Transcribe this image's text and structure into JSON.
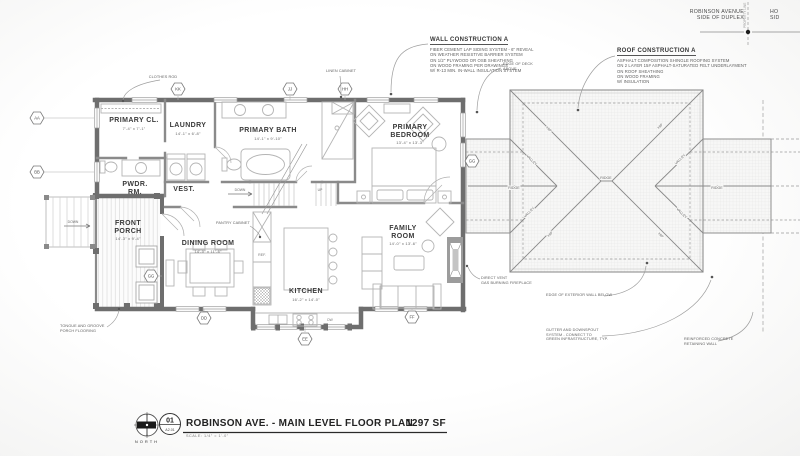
{
  "colors": {
    "wall": "#6e6e6e",
    "partition": "#8a8a8a",
    "furniture": "#b4b4b4",
    "roofline": "#8f8f8f",
    "text": "#3a3a3a"
  },
  "site": {
    "street_left_l1": "ROBINSON AVENUE",
    "street_left_l2": "SIDE OF DUPLEX",
    "street_right_l1": "HO",
    "street_right_l2": "SID",
    "property_line": "PROPERTY LINE"
  },
  "notes": {
    "wall_construction": {
      "title": "WALL CONSTRUCTION A",
      "lines": [
        "FIBER CEMENT LAP SIDING SYSTEM - 6\" REVEAL",
        "ON WEATHER RESISTIVE BARRIER SYSTEM",
        "ON 1/2\" PLYWOOD OR OSB SHEATHING",
        "ON WOOD FRAMING PER DRAWINGS",
        "W/ R-13 MIN. IN-WALL INSULATION SYSTEM"
      ]
    },
    "roof_construction": {
      "title": "ROOF CONSTRUCTION A",
      "lines": [
        "ASPHALT COMPOSITION SHINGLE ROOFING SYSTEM",
        "ON 2 LAYER 15# ASPHALT-SATURATED FELT UNDERLAYMENT",
        "ON ROOF SHEATHING",
        "ON WOOD FRAMING",
        "W/ INSULATION"
      ]
    },
    "edge_of_deck": {
      "l1": "EDGE OF DECK",
      "l2": "ABOVE"
    },
    "clothes_rod": "CLOTHES ROD",
    "linen_cabinet": "LINEN CABINET",
    "pantry_cabinet": "PANTRY CABINET",
    "tongue_groove": {
      "l1": "TONGUE AND GROOVE",
      "l2": "PORCH FLOORING"
    },
    "direct_vent": {
      "l1": "DIRECT VENT",
      "l2": "GAS BURNING FIREPLACE"
    },
    "edge_exterior_wall": "EDGE OF EXTERIOR WALL BELOW",
    "gutter": {
      "l1": "GUTTER AND DOWNSPOUT",
      "l2": "SYSTEM - CONNECT TO",
      "l3": "GREEN INFRASTRUCTURE, TYP."
    },
    "retaining_wall": {
      "l1": "REINFORCED CONCRETE",
      "l2": "RETAINING WALL"
    }
  },
  "rooms": {
    "primary_closet": {
      "name": "PRIMARY CL.",
      "dim": "7'-4\" x 7'-1\""
    },
    "laundry": {
      "name": "LAUNDRY",
      "dim": "14'-1\" x 6'-8\""
    },
    "primary_bath": {
      "name": "PRIMARY BATH",
      "dim": "14'-1\" x 9'-10\""
    },
    "primary_bedroom": {
      "name": "PRIMARY BEDROOM",
      "dim": "13'-4\" x 13'-3\""
    },
    "powder": {
      "name": "PWDR. RM.",
      "dim": ""
    },
    "vestibule": {
      "name": "VEST.",
      "dim": ""
    },
    "front_porch": {
      "name": "FRONT PORCH",
      "dim": "14'-3\" x 9'-4\""
    },
    "dining": {
      "name": "DINING ROOM",
      "dim": "14'-0\" x 11'-6\""
    },
    "kitchen": {
      "name": "KITCHEN",
      "dim": "16'-2\" x 14'-0\""
    },
    "family": {
      "name": "FAMILY ROOM",
      "dim": "14'-0\" x 13'-6\""
    }
  },
  "stairs": {
    "down": "DOWN",
    "up": "UP",
    "down_ext": "DOWN"
  },
  "kitchen_items": {
    "ref": "REF.",
    "dw": "DW"
  },
  "markers": {
    "aa": "AA",
    "bb": "BB",
    "dd": "DD",
    "ee": "EE",
    "ff": "FF",
    "gg": "GG",
    "hh": "HH",
    "jj": "JJ",
    "kk": "KK"
  },
  "roof": {
    "ridge": "RIDGE",
    "hip": "HIP",
    "valley": "VALLEY"
  },
  "titleblock": {
    "number": "01",
    "sheet": "A2.01",
    "title": "ROBINSON AVE. - MAIN LEVEL FLOOR PLAN",
    "area": "1297 SF",
    "scale": "SCALE:  1/4\" = 1'-0\"",
    "north": "NORTH"
  }
}
